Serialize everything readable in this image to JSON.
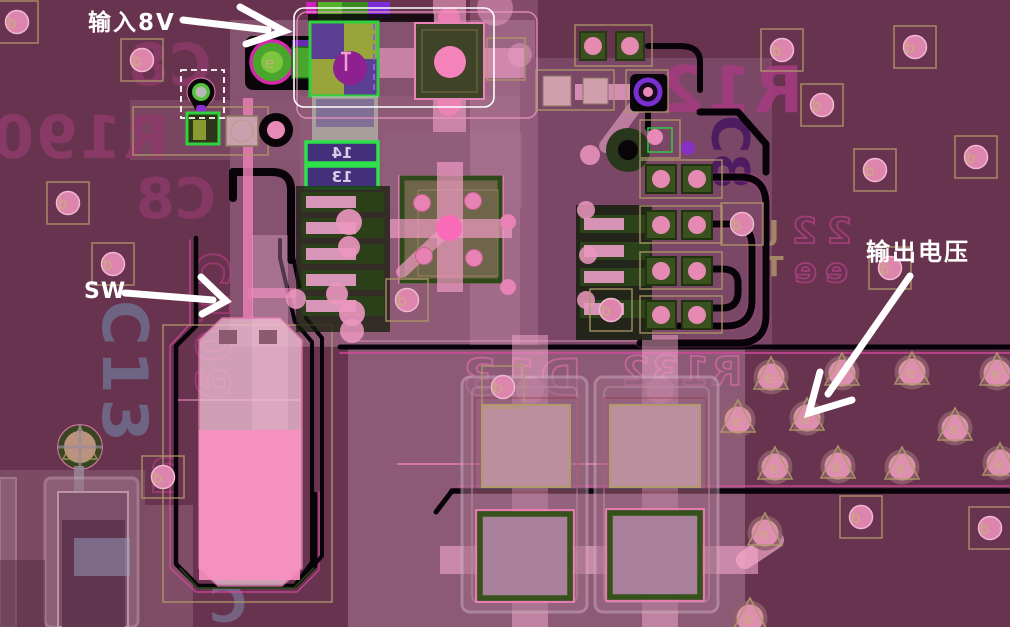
{
  "annotations": {
    "input_label": "输入8V",
    "sw_label": "SW",
    "output_label": "输出电压"
  },
  "silkscreen": {
    "r190": "R190",
    "c8_top": "C8",
    "c8_mid": "C8",
    "c13": "C13",
    "r12": "R12",
    "c8_right": "C8",
    "d13": "D13",
    "r132": "R132",
    "c109": "C109",
    "c2": "2",
    "twos": "22",
    "ees": "ee",
    "j_mark": "J",
    "t_mark": "T",
    "c_bottom": "C",
    "pin14": "14",
    "pin13": "13"
  },
  "via_labels": {
    "e": "e",
    "b": "b"
  },
  "colors": {
    "board_dark": "#67334e",
    "copper_light": "#8b5873",
    "pad_pink": "#e990b8",
    "pad_hot_pink": "#f96bb8",
    "green_border": "#2ed23e",
    "dark_green_pad": "#2c421a",
    "trace_black": "#070309",
    "silk_magenta": "#993068",
    "khaki_outline": "#b09a6a",
    "annotation_white": "#ffffff",
    "violet": "#5c3f92",
    "olive": "#97a53b"
  }
}
